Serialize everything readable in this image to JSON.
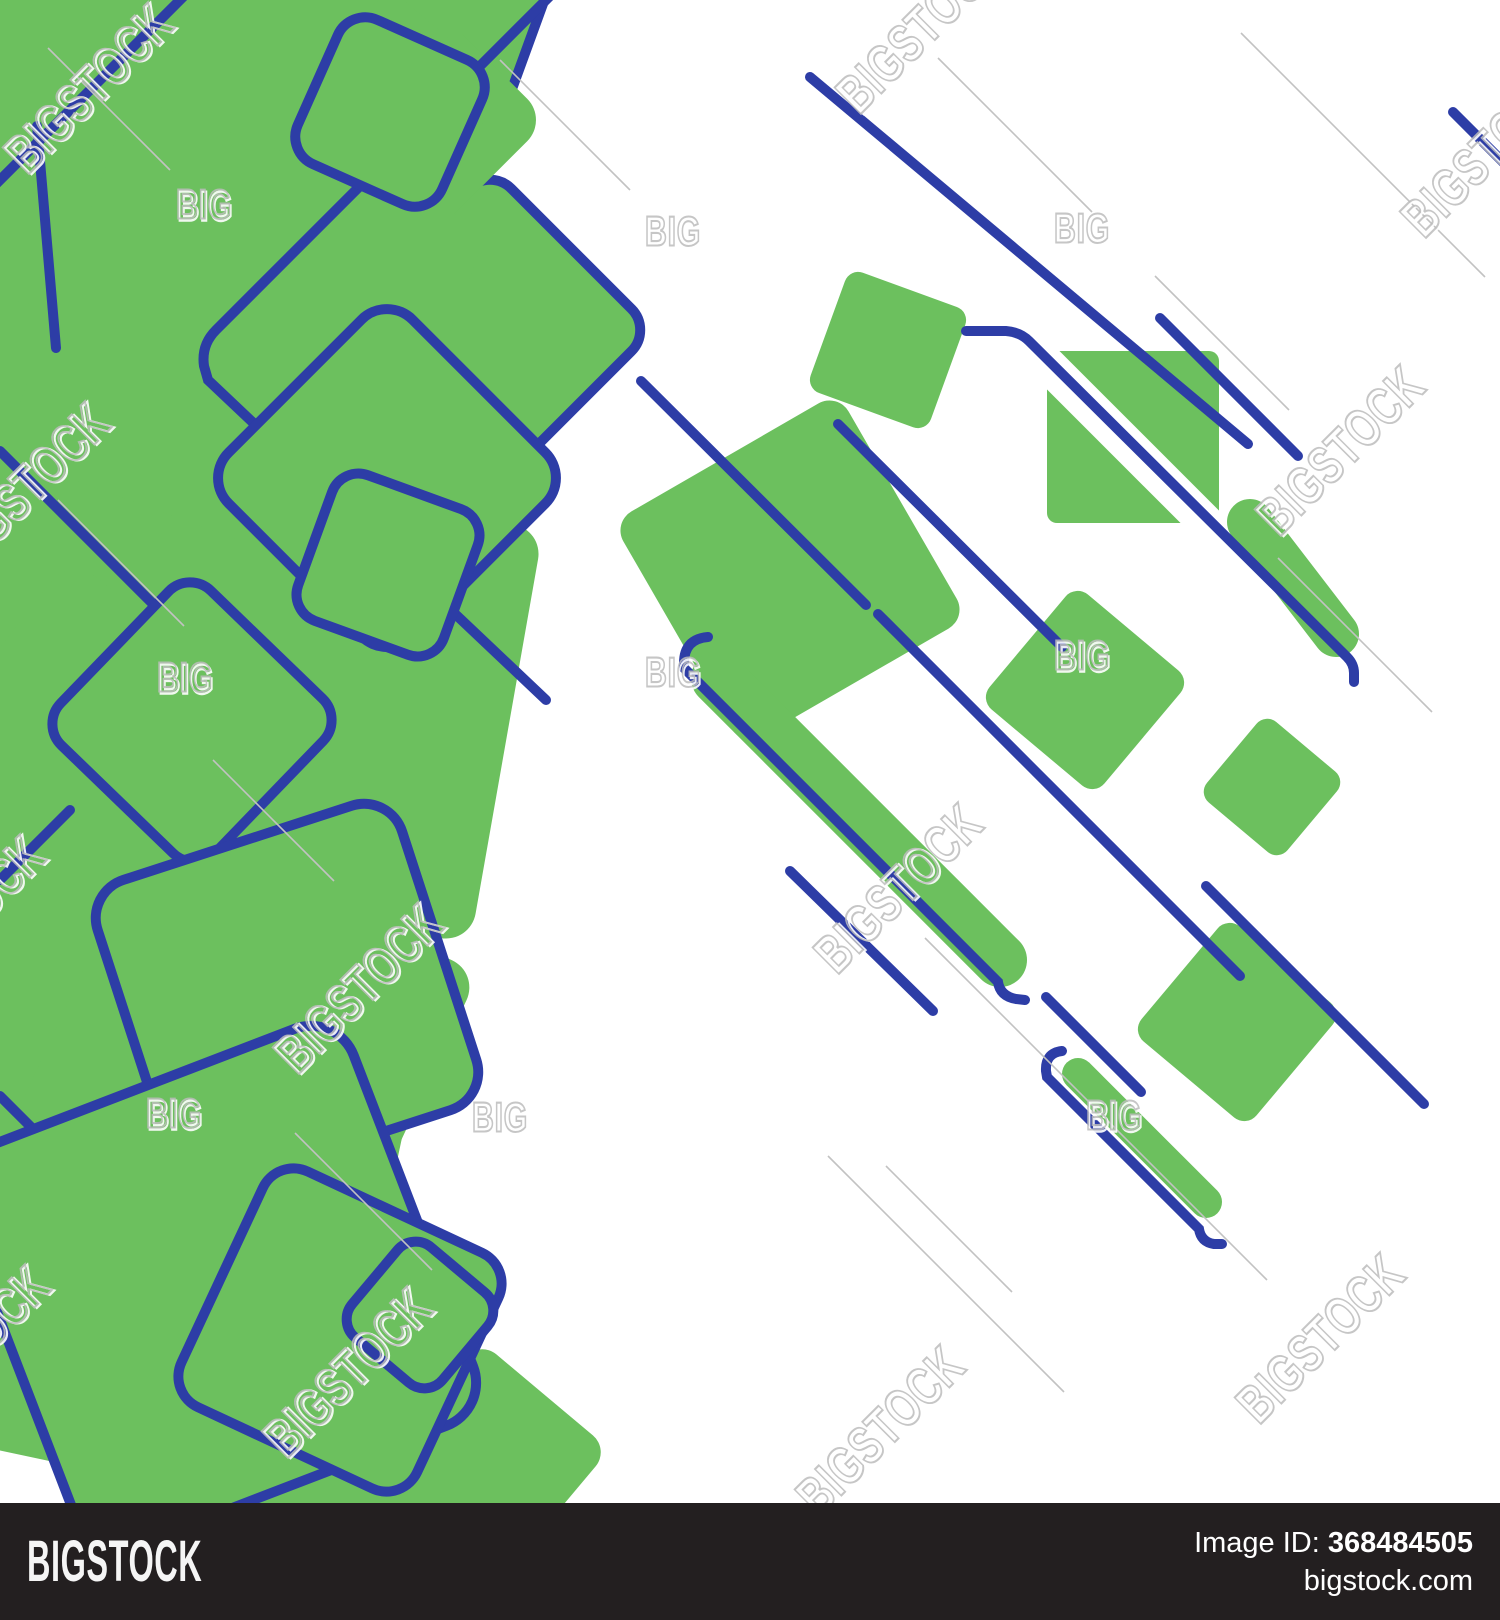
{
  "page": {
    "title": "Bigstock image preview",
    "background": "#ffffff"
  },
  "footer": {
    "logo": "BIGSTOCK",
    "image_id_label": "Image ID:",
    "image_id": "368484505",
    "site": "bigstock.com",
    "bg": "#231f20"
  },
  "watermark": {
    "word": "BIGSTOCK",
    "short_word": "BIG",
    "stroke_color": "#bdbdbd",
    "emboss_color": "#ffffff",
    "tile_line_color": "#c2c2c2",
    "words": [
      {
        "x": 88,
        "y": 88
      },
      {
        "x": 920,
        "y": 28
      },
      {
        "x": 1485,
        "y": 152
      },
      {
        "x": 25,
        "y": 487
      },
      {
        "x": 1340,
        "y": 450
      },
      {
        "x": 898,
        "y": 888
      },
      {
        "x": 358,
        "y": 988
      },
      {
        "x": -40,
        "y": 920
      },
      {
        "x": -35,
        "y": 1350
      },
      {
        "x": 347,
        "y": 1372
      },
      {
        "x": 880,
        "y": 1430
      },
      {
        "x": 1320,
        "y": 1338
      }
    ],
    "bits": [
      {
        "x": 204,
        "y": 204
      },
      {
        "x": 673,
        "y": 231
      },
      {
        "x": 1082,
        "y": 228
      },
      {
        "x": 185,
        "y": 677
      },
      {
        "x": 673,
        "y": 672
      },
      {
        "x": 1082,
        "y": 655
      },
      {
        "x": 174,
        "y": 1113
      },
      {
        "x": 500,
        "y": 1117
      },
      {
        "x": 1114,
        "y": 1115
      }
    ],
    "tile_lines": [
      {
        "x1": 938,
        "y1": 58,
        "x2": 1092,
        "y2": 212
      },
      {
        "x1": 1155,
        "y1": 276,
        "x2": 1289,
        "y2": 410
      },
      {
        "x1": 925,
        "y1": 938,
        "x2": 1267,
        "y2": 1280
      },
      {
        "x1": 828,
        "y1": 1156,
        "x2": 1064,
        "y2": 1392
      },
      {
        "x1": 886,
        "y1": 1166,
        "x2": 1012,
        "y2": 1292
      },
      {
        "x1": 1241,
        "y1": 33,
        "x2": 1485,
        "y2": 277
      },
      {
        "x1": 48,
        "y1": 48,
        "x2": 170,
        "y2": 170
      },
      {
        "x1": 58,
        "y1": 500,
        "x2": 184,
        "y2": 626
      },
      {
        "x1": 295,
        "y1": 1133,
        "x2": 432,
        "y2": 1270
      },
      {
        "x1": 213,
        "y1": 760,
        "x2": 334,
        "y2": 881
      },
      {
        "x1": 1278,
        "y1": 558,
        "x2": 1432,
        "y2": 712
      },
      {
        "x1": 500,
        "y1": 60,
        "x2": 630,
        "y2": 190
      }
    ]
  },
  "artwork": {
    "green": "#6cc05e",
    "blue": "#2d3da6",
    "line_width": 10,
    "back_squares": [
      {
        "cx": 395,
        "cy": 45,
        "s": 250,
        "rot": 20,
        "rx": 26
      },
      {
        "cx": 490,
        "cy": 330,
        "s": 230,
        "rot": 45,
        "rx": 30
      }
    ],
    "fills": [
      {
        "cx": 110,
        "cy": 120,
        "s": 620,
        "rot": 45,
        "rx": 30
      },
      {
        "cx": 85,
        "cy": 520,
        "s": 400,
        "rot": 12,
        "rx": 30
      },
      {
        "cx": 300,
        "cy": 700,
        "s": 420,
        "rot": 10,
        "rx": 30
      },
      {
        "cx": 110,
        "cy": 880,
        "s": 460,
        "rot": 38,
        "rx": 30
      },
      {
        "cx": 140,
        "cy": 1240,
        "s": 470,
        "rot": 12,
        "rx": 30
      },
      {
        "cx": 320,
        "cy": 1440,
        "s": 260,
        "rot": 40,
        "rx": 26
      },
      {
        "cx": 398,
        "cy": 100,
        "s": 160,
        "rot": 40,
        "rx": 24
      },
      {
        "cx": 245,
        "cy": 340,
        "s": 380,
        "rot": 20,
        "rx": 30
      },
      {
        "cx": 240,
        "cy": 1060,
        "s": 360,
        "rot": 25,
        "rx": 30
      },
      {
        "cx": 490,
        "cy": 1460,
        "s": 170,
        "rot": 40,
        "rx": 22
      }
    ],
    "left_lines": [
      {
        "x1": 184,
        "y1": -4,
        "x2": -4,
        "y2": 184
      },
      {
        "x1": 0,
        "y1": 451,
        "x2": 264,
        "y2": 715
      },
      {
        "x1": 70,
        "y1": 810,
        "x2": 0,
        "y2": 880
      },
      {
        "x1": 37,
        "y1": 126,
        "x2": 56,
        "y2": 348
      },
      {
        "x1": 0,
        "y1": 1096,
        "x2": 90,
        "y2": 1186
      }
    ],
    "left_paths": [
      {
        "d": "M 558,-12 L 216,330 q -15,15 -12,36 l 4,14 L 546,700"
      }
    ],
    "front_squares": [
      {
        "cx": 390,
        "cy": 112,
        "s": 158,
        "rot": 24,
        "rx": 30
      },
      {
        "cx": 387,
        "cy": 478,
        "s": 260,
        "rot": 45,
        "rx": 36
      },
      {
        "cx": 388,
        "cy": 565,
        "s": 155,
        "rot": 20,
        "rx": 28
      },
      {
        "cx": 192,
        "cy": 722,
        "s": 215,
        "rot": 44,
        "rx": 30
      },
      {
        "cx": 287,
        "cy": 995,
        "s": 320,
        "rot": -18,
        "rx": 40
      },
      {
        "cx": 215,
        "cy": 1287,
        "s": 425,
        "rot": -21,
        "rx": 46
      },
      {
        "cx": 340,
        "cy": 1330,
        "s": 260,
        "rot": 25,
        "rx": 34
      },
      {
        "cx": 420,
        "cy": 1315,
        "s": 118,
        "rot": 40,
        "rx": 24
      }
    ],
    "right_fills": [
      {
        "cx": 888,
        "cy": 350,
        "s": 128,
        "rot": 20,
        "rx": 14
      },
      {
        "cx": 1133,
        "cy": 437,
        "s": 172,
        "rot": 0,
        "rx": 10
      },
      {
        "cx": 790,
        "cy": 570,
        "s": 260,
        "rot": -30,
        "rx": 22
      },
      {
        "cx": 1085,
        "cy": 690,
        "s": 150,
        "rot": 40,
        "rx": 16
      },
      {
        "cx": 1272,
        "cy": 787,
        "s": 105,
        "rot": 40,
        "rx": 14
      },
      {
        "cx": 1237,
        "cy": 1022,
        "s": 150,
        "rot": 40,
        "rx": 16
      }
    ],
    "white_band": {
      "x1": 975,
      "y1": 292,
      "x2": 1212,
      "y2": 529,
      "w": 36
    },
    "bars": [
      {
        "x1": 1250,
        "y1": 522,
        "x2": 1336,
        "y2": 634,
        "w": 46
      },
      {
        "x1": 718,
        "y1": 678,
        "x2": 1000,
        "y2": 960,
        "w": 54
      },
      {
        "x1": 1078,
        "y1": 1074,
        "x2": 1206,
        "y2": 1202,
        "w": 32
      }
    ],
    "hooks": [
      {
        "d": "M 966,331 l 40,0 q 14,1 23,10 l 318,316 q 7,7 7,16 l 0,9"
      },
      {
        "d": "M 708,637 q -24,2 -24,26 l 0,5 l 314,314 q 2,14 18,17 l 9,1"
      },
      {
        "d": "M 1062,1051 q -17,2 -16,20 l 1,6 l 152,152 q 2,13 15,15 l 8,0"
      }
    ],
    "lines": [
      {
        "x1": 810,
        "y1": 77,
        "x2": 1248,
        "y2": 444
      },
      {
        "x1": 1160,
        "y1": 318,
        "x2": 1298,
        "y2": 456
      },
      {
        "x1": 641,
        "y1": 381,
        "x2": 866,
        "y2": 605
      },
      {
        "x1": 878,
        "y1": 614,
        "x2": 1240,
        "y2": 976
      },
      {
        "x1": 838,
        "y1": 424,
        "x2": 1062,
        "y2": 647
      },
      {
        "x1": 790,
        "y1": 871,
        "x2": 933,
        "y2": 1011
      },
      {
        "x1": 1046,
        "y1": 997,
        "x2": 1141,
        "y2": 1092
      },
      {
        "x1": 1206,
        "y1": 886,
        "x2": 1424,
        "y2": 1104
      },
      {
        "x1": 1453,
        "y1": 112,
        "x2": 1510,
        "y2": 169
      }
    ]
  }
}
